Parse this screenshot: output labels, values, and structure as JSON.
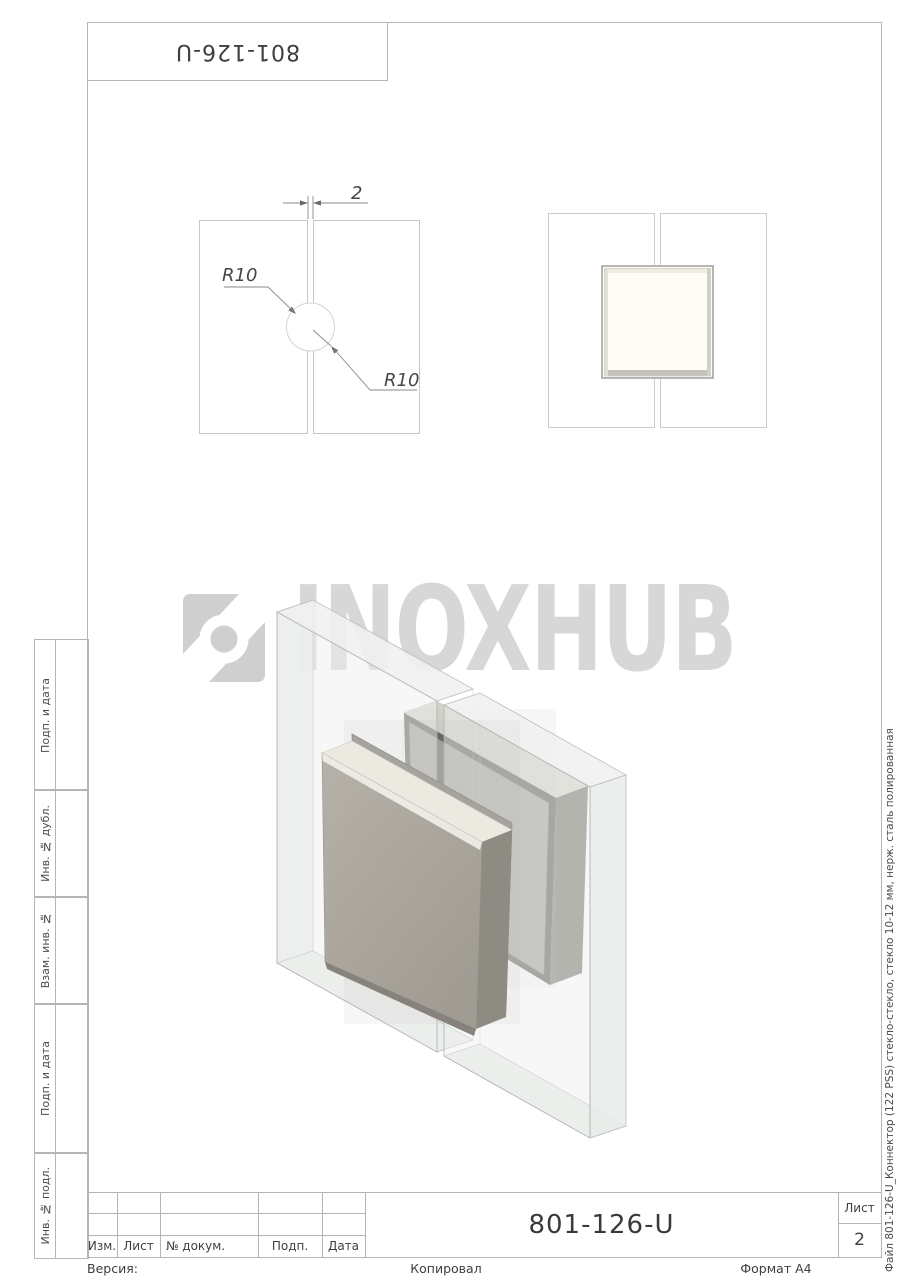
{
  "page": {
    "top_box_number": "801-126-U",
    "watermark_text": "INOXHUB",
    "file_note": "Файл  801-126-U_Коннектор (122 PSS) стекло-стекло, стекло 10-12 мм, нерж. сталь полированная"
  },
  "sidebar": {
    "items": [
      {
        "label": "Подп. и дата"
      },
      {
        "label": "Инв. № дубл."
      },
      {
        "label": "Взам. инв. №"
      },
      {
        "label": "Подп. и дата"
      },
      {
        "label": "Инв. № подл."
      }
    ]
  },
  "title_block": {
    "columns": [
      "Изм.",
      "Лист",
      "№ докум.",
      "Подп.",
      "Дата"
    ],
    "doc_number": "801-126-U",
    "sheet_label": "Лист",
    "sheet_number": "2"
  },
  "footer": {
    "version_label": "Версия:",
    "copied_label": "Копировал",
    "format_label": "Формат A4"
  },
  "drawing": {
    "gap_dimension": "2",
    "radius_top": "R10",
    "radius_bottom": "R10"
  },
  "colors": {
    "frame_line": "#b5b5b5",
    "text": "#4a4a4a",
    "watermark": "#d7d7d7",
    "steel_face": "#b6b2a9",
    "steel_top": "#ece9e1",
    "gasket": "#a09d97"
  }
}
